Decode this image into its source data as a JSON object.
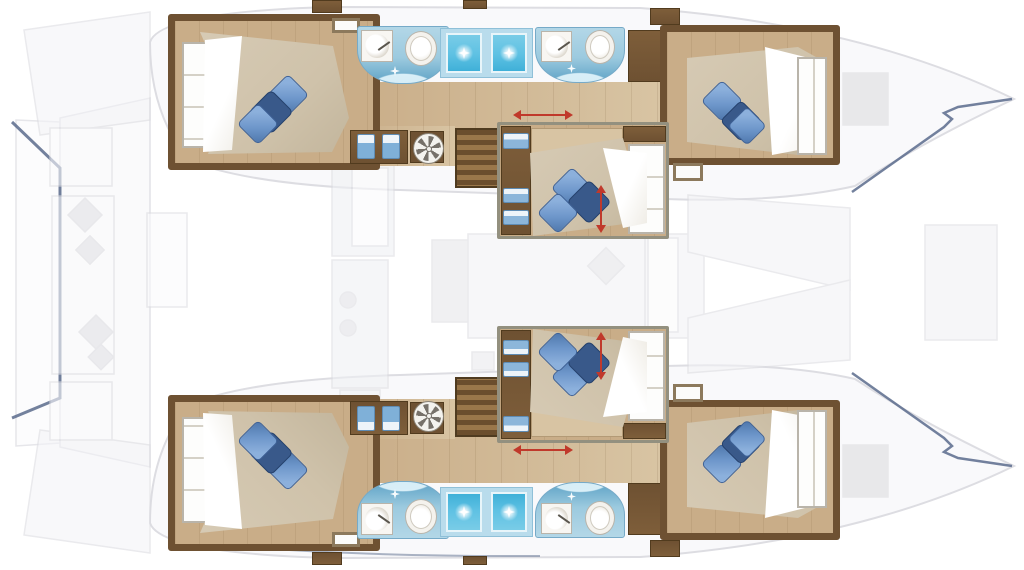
{
  "diagram": {
    "type": "floorplan",
    "subject": "catamaran-yacht-lower-deck-layout",
    "orientation": "bow-right-stern-left",
    "visible_text": []
  },
  "palette": {
    "background": "#ffffff",
    "hull_faint_fill": "#f7f7f9",
    "hull_faint_stroke": "#dddde2",
    "deck_line_navy": "#5a6b8c",
    "wall_wood": "#6e5132",
    "floor_tan": "#c9ad88",
    "floor_light": "#d8c4a3",
    "mattress_beige": "#cfc2aa",
    "sheet_white": "#ffffff",
    "pillow_blue": "#6d96ca",
    "pillow_navy": "#39598a",
    "tile_blue": "#9ccadf",
    "tile_blue_deep": "#5fa3c6",
    "shower_cyan": "#5ec1e3",
    "shower_frame": "#b9dcec",
    "fixture_white": "#f4f2ed",
    "fixture_shadow": "#b9b4aa",
    "marker_red": "#c0392b",
    "faint_furniture": "#e9e9ee"
  },
  "inventory": {
    "hulls": [
      {
        "name": "upper-hull",
        "cabins": [
          {
            "name": "aft-cabin",
            "pillows": 3,
            "wardrobe": true,
            "hatch": true
          },
          {
            "name": "forward-cabin",
            "pillows": 3,
            "wardrobe": true
          }
        ],
        "bathrooms": [
          {
            "name": "aft-bathroom",
            "fixtures": [
              "sink",
              "toilet"
            ]
          },
          {
            "name": "forward-bathroom",
            "fixtures": [
              "sink",
              "toilet"
            ]
          }
        ],
        "showers": 2,
        "stairs": 1,
        "ceiling_fan": 1,
        "steps_seats": 2
      },
      {
        "name": "lower-hull",
        "cabins": [
          {
            "name": "aft-cabin",
            "pillows": 3,
            "wardrobe": true,
            "hatch": true
          },
          {
            "name": "forward-cabin",
            "pillows": 3,
            "wardrobe": true
          }
        ],
        "bathrooms": [
          {
            "name": "aft-bathroom",
            "fixtures": [
              "sink",
              "toilet"
            ]
          },
          {
            "name": "forward-bathroom",
            "fixtures": [
              "sink",
              "toilet"
            ]
          }
        ],
        "showers": 2,
        "stairs": 1,
        "ceiling_fan": 1,
        "steps_seats": 2
      }
    ],
    "center_cabins": [
      {
        "name": "upper-center-cabin",
        "pillows": 3,
        "drawers": 3,
        "markers": [
          "door-arrow",
          "berth-arrow"
        ]
      },
      {
        "name": "lower-center-cabin",
        "pillows": 3,
        "drawers": 3,
        "markers": [
          "door-arrow",
          "berth-arrow"
        ]
      }
    ],
    "icons": [
      "toilet-icon",
      "sink-icon",
      "shower-sparkle-icon",
      "fan-icon",
      "stairs-icon",
      "pillow-icon",
      "red-arrow-marker"
    ]
  }
}
